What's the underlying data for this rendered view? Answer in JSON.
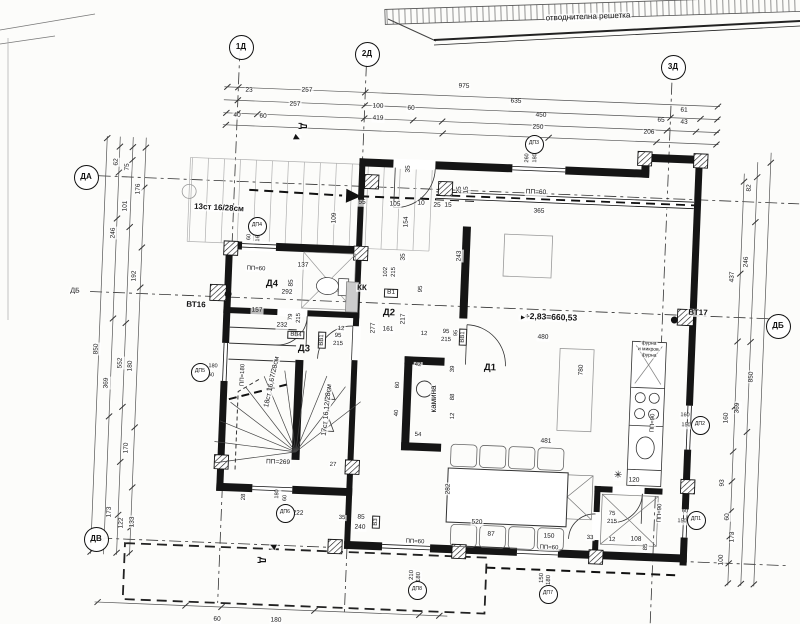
{
  "site": {
    "note": "отводнителна решетка"
  },
  "grid_markers": [
    {
      "t": "1Д",
      "x": 240,
      "y": 46
    },
    {
      "t": "2Д",
      "x": 366,
      "y": 53
    },
    {
      "t": "3Д",
      "x": 672,
      "y": 66
    },
    {
      "t": "ДА",
      "x": 85,
      "y": 176
    },
    {
      "t": "ДВ",
      "x": 95,
      "y": 538
    },
    {
      "t": "ДБ",
      "x": 777,
      "y": 325
    }
  ],
  "opening_tags": [
    {
      "t": "ДП4",
      "x": 256,
      "y": 225
    },
    {
      "t": "ДП3",
      "x": 533,
      "y": 143
    },
    {
      "t": "ДП5",
      "x": 199,
      "y": 371
    },
    {
      "t": "ДП6",
      "x": 284,
      "y": 512
    },
    {
      "t": "ДП8",
      "x": 416,
      "y": 589
    },
    {
      "t": "ДП7",
      "x": 547,
      "y": 593
    },
    {
      "t": "ДП2",
      "x": 699,
      "y": 424
    },
    {
      "t": "ДП1",
      "x": 695,
      "y": 519
    }
  ],
  "room_labels": [
    {
      "t": "Д1",
      "x": 490,
      "y": 368
    },
    {
      "t": "Д2",
      "x": 389,
      "y": 313
    },
    {
      "t": "Д3",
      "x": 304,
      "y": 349
    },
    {
      "t": "Д4",
      "x": 272,
      "y": 284
    }
  ],
  "notes": [
    {
      "t": "отводнителна решетка",
      "x": 588,
      "y": 17,
      "s": 8,
      "r": -2,
      "n": "site-note"
    },
    {
      "t": "+2,83=660,53",
      "x": 551,
      "y": 317,
      "s": 8.5,
      "b": 1,
      "n": "elevation-note"
    },
    {
      "t": "►",
      "x": 523,
      "y": 318,
      "s": 7,
      "n": "elevation-flag-icon"
    },
    {
      "t": "ВТ16",
      "x": 196,
      "y": 305,
      "s": 8,
      "b": 1,
      "n": "vent-shaft-label"
    },
    {
      "t": "ВТ17",
      "x": 698,
      "y": 313,
      "s": 8,
      "b": 1,
      "n": "vent-shaft-label"
    },
    {
      "t": "КК",
      "x": 362,
      "y": 288,
      "s": 8,
      "b": 1,
      "n": "duct-label"
    },
    {
      "t": "камина",
      "x": 434,
      "y": 399,
      "s": 8,
      "r": -90,
      "n": "fireplace-label"
    },
    {
      "t": "13ст 16/28см",
      "x": 219,
      "y": 208,
      "s": 8,
      "b": 1,
      "r": 3,
      "n": "stair-note"
    },
    {
      "t": "18ст 16,67/28см",
      "x": 272,
      "y": 382,
      "s": 7,
      "r": -78,
      "n": "stair-note"
    },
    {
      "t": "17ст 16,12/28см",
      "x": 327,
      "y": 410,
      "s": 7,
      "r": -84,
      "n": "stair-note"
    },
    {
      "t": "ПП=269",
      "x": 278,
      "y": 463,
      "s": 6.5
    },
    {
      "t": "ПП=180",
      "x": 243,
      "y": 375,
      "s": 6,
      "r": -88
    },
    {
      "t": "ПП=60",
      "x": 536,
      "y": 193,
      "s": 6.5
    },
    {
      "t": "ПП=60",
      "x": 256,
      "y": 269,
      "s": 6
    },
    {
      "t": "ПП=60",
      "x": 415,
      "y": 542,
      "s": 6
    },
    {
      "t": "ПП=60",
      "x": 549,
      "y": 548,
      "s": 6
    },
    {
      "t": "ПП=90",
      "x": 660,
      "y": 513,
      "s": 6,
      "r": -88
    },
    {
      "t": "ПП=90",
      "x": 653,
      "y": 423,
      "s": 6,
      "r": -88
    },
    {
      "t": "ДБ",
      "x": 75,
      "y": 291,
      "s": 7,
      "n": "axis-label"
    },
    {
      "t": "Д",
      "x": 303,
      "y": 126,
      "s": 9,
      "b": 1,
      "r": 90,
      "n": "section-letter"
    },
    {
      "t": "Д",
      "x": 262,
      "y": 560,
      "s": 9,
      "b": 1,
      "r": 90,
      "n": "section-letter"
    },
    {
      "t": "▶",
      "x": 297,
      "y": 138,
      "s": 8,
      "r": 25,
      "n": "section-arrow-icon"
    },
    {
      "t": "▶",
      "x": 273,
      "y": 546,
      "s": 8,
      "r": -155,
      "n": "section-arrow-icon"
    },
    {
      "t": "✳",
      "x": 618,
      "y": 476,
      "s": 10,
      "b": 1,
      "n": "shaft-mark"
    },
    {
      "t": "фурна",
      "x": 649,
      "y": 344,
      "s": 5,
      "n": "kitchen-note"
    },
    {
      "t": "и микров.",
      "x": 649,
      "y": 350,
      "s": 5,
      "n": "kitchen-note"
    },
    {
      "t": "фурна",
      "x": 649,
      "y": 356,
      "s": 5,
      "n": "kitchen-note"
    },
    {
      "t": "В1",
      "x": 391,
      "y": 293,
      "s": 6.5,
      "box": 1,
      "n": "door-tag"
    },
    {
      "t": "ВВ4",
      "x": 296,
      "y": 335,
      "s": 6,
      "box": 1,
      "n": "door-tag"
    },
    {
      "t": "ВВ1",
      "x": 322,
      "y": 340,
      "s": 6,
      "box": 1,
      "r": -88,
      "n": "door-tag"
    },
    {
      "t": "ВВ1",
      "x": 463,
      "y": 337,
      "s": 6,
      "box": 1,
      "r": -88,
      "n": "door-tag"
    },
    {
      "t": "В3",
      "x": 376,
      "y": 522,
      "s": 6,
      "box": 1,
      "r": -88,
      "n": "door-tag"
    }
  ],
  "dim_labels": [
    {
      "t": "23",
      "x": 249,
      "y": 91
    },
    {
      "t": "257",
      "x": 307,
      "y": 91
    },
    {
      "t": "975",
      "x": 464,
      "y": 87
    },
    {
      "t": "257",
      "x": 295,
      "y": 105
    },
    {
      "t": "100",
      "x": 378,
      "y": 107
    },
    {
      "t": "60",
      "x": 411,
      "y": 109
    },
    {
      "t": "635",
      "x": 516,
      "y": 102
    },
    {
      "t": "61",
      "x": 684,
      "y": 111
    },
    {
      "t": "40",
      "x": 237,
      "y": 116
    },
    {
      "t": "60",
      "x": 263,
      "y": 117
    },
    {
      "t": "419",
      "x": 378,
      "y": 119
    },
    {
      "t": "450",
      "x": 541,
      "y": 116
    },
    {
      "t": "65",
      "x": 661,
      "y": 121
    },
    {
      "t": "43",
      "x": 684,
      "y": 123
    },
    {
      "t": "250",
      "x": 538,
      "y": 128
    },
    {
      "t": "206",
      "x": 649,
      "y": 133
    },
    {
      "t": "62",
      "x": 117,
      "y": 162,
      "r": -88
    },
    {
      "t": "75",
      "x": 128,
      "y": 167,
      "r": -88
    },
    {
      "t": "176",
      "x": 139,
      "y": 189,
      "r": -88
    },
    {
      "t": "101",
      "x": 126,
      "y": 206,
      "r": -88
    },
    {
      "t": "246",
      "x": 114,
      "y": 233,
      "r": -88
    },
    {
      "t": "192",
      "x": 135,
      "y": 276,
      "r": -88
    },
    {
      "t": "850",
      "x": 97,
      "y": 349,
      "r": -88
    },
    {
      "t": "552",
      "x": 121,
      "y": 363,
      "r": -88
    },
    {
      "t": "180",
      "x": 131,
      "y": 366,
      "r": -88
    },
    {
      "t": "369",
      "x": 107,
      "y": 383,
      "r": -88
    },
    {
      "t": "170",
      "x": 127,
      "y": 448,
      "r": -88
    },
    {
      "t": "173",
      "x": 110,
      "y": 512,
      "r": -88
    },
    {
      "t": "122",
      "x": 122,
      "y": 523,
      "r": -88
    },
    {
      "t": "133",
      "x": 133,
      "y": 522,
      "r": -88
    },
    {
      "t": "82",
      "x": 750,
      "y": 188,
      "r": -88
    },
    {
      "t": "246",
      "x": 747,
      "y": 262,
      "r": -88
    },
    {
      "t": "437",
      "x": 733,
      "y": 277,
      "r": -88
    },
    {
      "t": "850",
      "x": 752,
      "y": 377,
      "r": -88
    },
    {
      "t": "369",
      "x": 738,
      "y": 408,
      "r": -88
    },
    {
      "t": "160",
      "x": 727,
      "y": 418,
      "r": -88
    },
    {
      "t": "93",
      "x": 723,
      "y": 483,
      "r": -88
    },
    {
      "t": "60",
      "x": 728,
      "y": 517,
      "r": -88
    },
    {
      "t": "173",
      "x": 733,
      "y": 537,
      "r": -88
    },
    {
      "t": "100",
      "x": 722,
      "y": 560,
      "r": -88
    },
    {
      "t": "60",
      "x": 217,
      "y": 620
    },
    {
      "t": "180",
      "x": 276,
      "y": 621
    },
    {
      "t": "35",
      "x": 409,
      "y": 169,
      "r": -88
    },
    {
      "t": "55",
      "x": 362,
      "y": 203
    },
    {
      "t": "105",
      "x": 395,
      "y": 205
    },
    {
      "t": "10",
      "x": 421,
      "y": 204
    },
    {
      "t": "25",
      "x": 437,
      "y": 206
    },
    {
      "t": "15",
      "x": 448,
      "y": 206
    },
    {
      "t": "25",
      "x": 460,
      "y": 190,
      "r": -88
    },
    {
      "t": "15",
      "x": 467,
      "y": 190,
      "r": -88
    },
    {
      "t": "154",
      "x": 407,
      "y": 222,
      "r": -88
    },
    {
      "t": "109",
      "x": 335,
      "y": 218,
      "r": -88
    },
    {
      "t": "35",
      "x": 404,
      "y": 257,
      "r": -88
    },
    {
      "t": "243",
      "x": 460,
      "y": 256,
      "r": -88
    },
    {
      "t": "365",
      "x": 539,
      "y": 212
    },
    {
      "t": "260",
      "x": 528,
      "y": 158,
      "r": -88,
      "s": 5.5
    },
    {
      "t": "180",
      "x": 536,
      "y": 158,
      "r": -88,
      "s": 5.5
    },
    {
      "t": "137",
      "x": 303,
      "y": 266
    },
    {
      "t": "85",
      "x": 292,
      "y": 283,
      "r": -88
    },
    {
      "t": "292",
      "x": 287,
      "y": 293
    },
    {
      "t": "157",
      "x": 257,
      "y": 311
    },
    {
      "t": "232",
      "x": 282,
      "y": 326
    },
    {
      "t": "79",
      "x": 291,
      "y": 317,
      "r": -88,
      "s": 6
    },
    {
      "t": "215",
      "x": 299,
      "y": 318,
      "r": -88,
      "s": 6
    },
    {
      "t": "12",
      "x": 341,
      "y": 329,
      "s": 6
    },
    {
      "t": "95",
      "x": 338,
      "y": 336,
      "s": 6
    },
    {
      "t": "215",
      "x": 338,
      "y": 344,
      "s": 6
    },
    {
      "t": "60",
      "x": 250,
      "y": 237,
      "r": -88,
      "s": 5.5
    },
    {
      "t": "160",
      "x": 259,
      "y": 237,
      "r": -88,
      "s": 5.5
    },
    {
      "t": "102",
      "x": 386,
      "y": 272,
      "r": -88,
      "s": 6
    },
    {
      "t": "215",
      "x": 394,
      "y": 272,
      "r": -88,
      "s": 6
    },
    {
      "t": "95",
      "x": 421,
      "y": 289,
      "r": -88,
      "s": 6
    },
    {
      "t": "217",
      "x": 404,
      "y": 319,
      "r": -88
    },
    {
      "t": "277",
      "x": 374,
      "y": 328,
      "r": -88
    },
    {
      "t": "161",
      "x": 388,
      "y": 330
    },
    {
      "t": "12",
      "x": 424,
      "y": 334,
      "s": 6
    },
    {
      "t": "95",
      "x": 446,
      "y": 332,
      "s": 6
    },
    {
      "t": "215",
      "x": 446,
      "y": 340,
      "s": 6
    },
    {
      "t": "95",
      "x": 457,
      "y": 333,
      "r": -88,
      "s": 5.5
    },
    {
      "t": "480",
      "x": 543,
      "y": 338
    },
    {
      "t": "780",
      "x": 582,
      "y": 370,
      "r": -88
    },
    {
      "t": "42",
      "x": 418,
      "y": 365,
      "s": 6
    },
    {
      "t": "60",
      "x": 398,
      "y": 385,
      "r": -88,
      "s": 6
    },
    {
      "t": "40",
      "x": 397,
      "y": 413,
      "r": -88,
      "s": 6
    },
    {
      "t": "54",
      "x": 418,
      "y": 435,
      "s": 6
    },
    {
      "t": "39",
      "x": 453,
      "y": 369,
      "r": -88,
      "s": 6
    },
    {
      "t": "88",
      "x": 453,
      "y": 397,
      "r": -88,
      "s": 6
    },
    {
      "t": "12",
      "x": 453,
      "y": 416,
      "r": -88,
      "s": 6
    },
    {
      "t": "481",
      "x": 546,
      "y": 442
    },
    {
      "t": "282",
      "x": 449,
      "y": 489,
      "r": -88
    },
    {
      "t": "520",
      "x": 477,
      "y": 523
    },
    {
      "t": "87",
      "x": 491,
      "y": 535
    },
    {
      "t": "150",
      "x": 549,
      "y": 537
    },
    {
      "t": "120",
      "x": 634,
      "y": 481
    },
    {
      "t": "75",
      "x": 612,
      "y": 514,
      "s": 6
    },
    {
      "t": "215",
      "x": 612,
      "y": 522,
      "s": 6
    },
    {
      "t": "33",
      "x": 590,
      "y": 538,
      "s": 6
    },
    {
      "t": "12",
      "x": 612,
      "y": 540,
      "s": 6
    },
    {
      "t": "108",
      "x": 636,
      "y": 540
    },
    {
      "t": "85",
      "x": 646,
      "y": 547,
      "r": -88,
      "s": 6
    },
    {
      "t": "60",
      "x": 685,
      "y": 512,
      "s": 5.5
    },
    {
      "t": "150",
      "x": 682,
      "y": 522,
      "s": 5.5
    },
    {
      "t": "160",
      "x": 685,
      "y": 416,
      "s": 5.5
    },
    {
      "t": "150",
      "x": 686,
      "y": 426,
      "s": 5.5
    },
    {
      "t": "35",
      "x": 342,
      "y": 518,
      "s": 6
    },
    {
      "t": "85",
      "x": 361,
      "y": 518
    },
    {
      "t": "240",
      "x": 360,
      "y": 528
    },
    {
      "t": "210",
      "x": 412,
      "y": 575,
      "r": -88,
      "s": 6
    },
    {
      "t": "180",
      "x": 419,
      "y": 577,
      "r": -88,
      "s": 6
    },
    {
      "t": "150",
      "x": 542,
      "y": 578,
      "r": -88,
      "s": 6
    },
    {
      "t": "180",
      "x": 549,
      "y": 580,
      "r": -88,
      "s": 6
    },
    {
      "t": "28",
      "x": 244,
      "y": 497,
      "r": -88,
      "s": 6
    },
    {
      "t": "180",
      "x": 278,
      "y": 494,
      "r": -88,
      "s": 5.5
    },
    {
      "t": "60",
      "x": 286,
      "y": 498,
      "r": -88,
      "s": 5.5
    },
    {
      "t": "222",
      "x": 298,
      "y": 514
    },
    {
      "t": "27",
      "x": 333,
      "y": 465,
      "s": 6
    },
    {
      "t": "180",
      "x": 213,
      "y": 367,
      "s": 5.5
    },
    {
      "t": "60",
      "x": 211,
      "y": 376,
      "s": 5.5
    }
  ]
}
